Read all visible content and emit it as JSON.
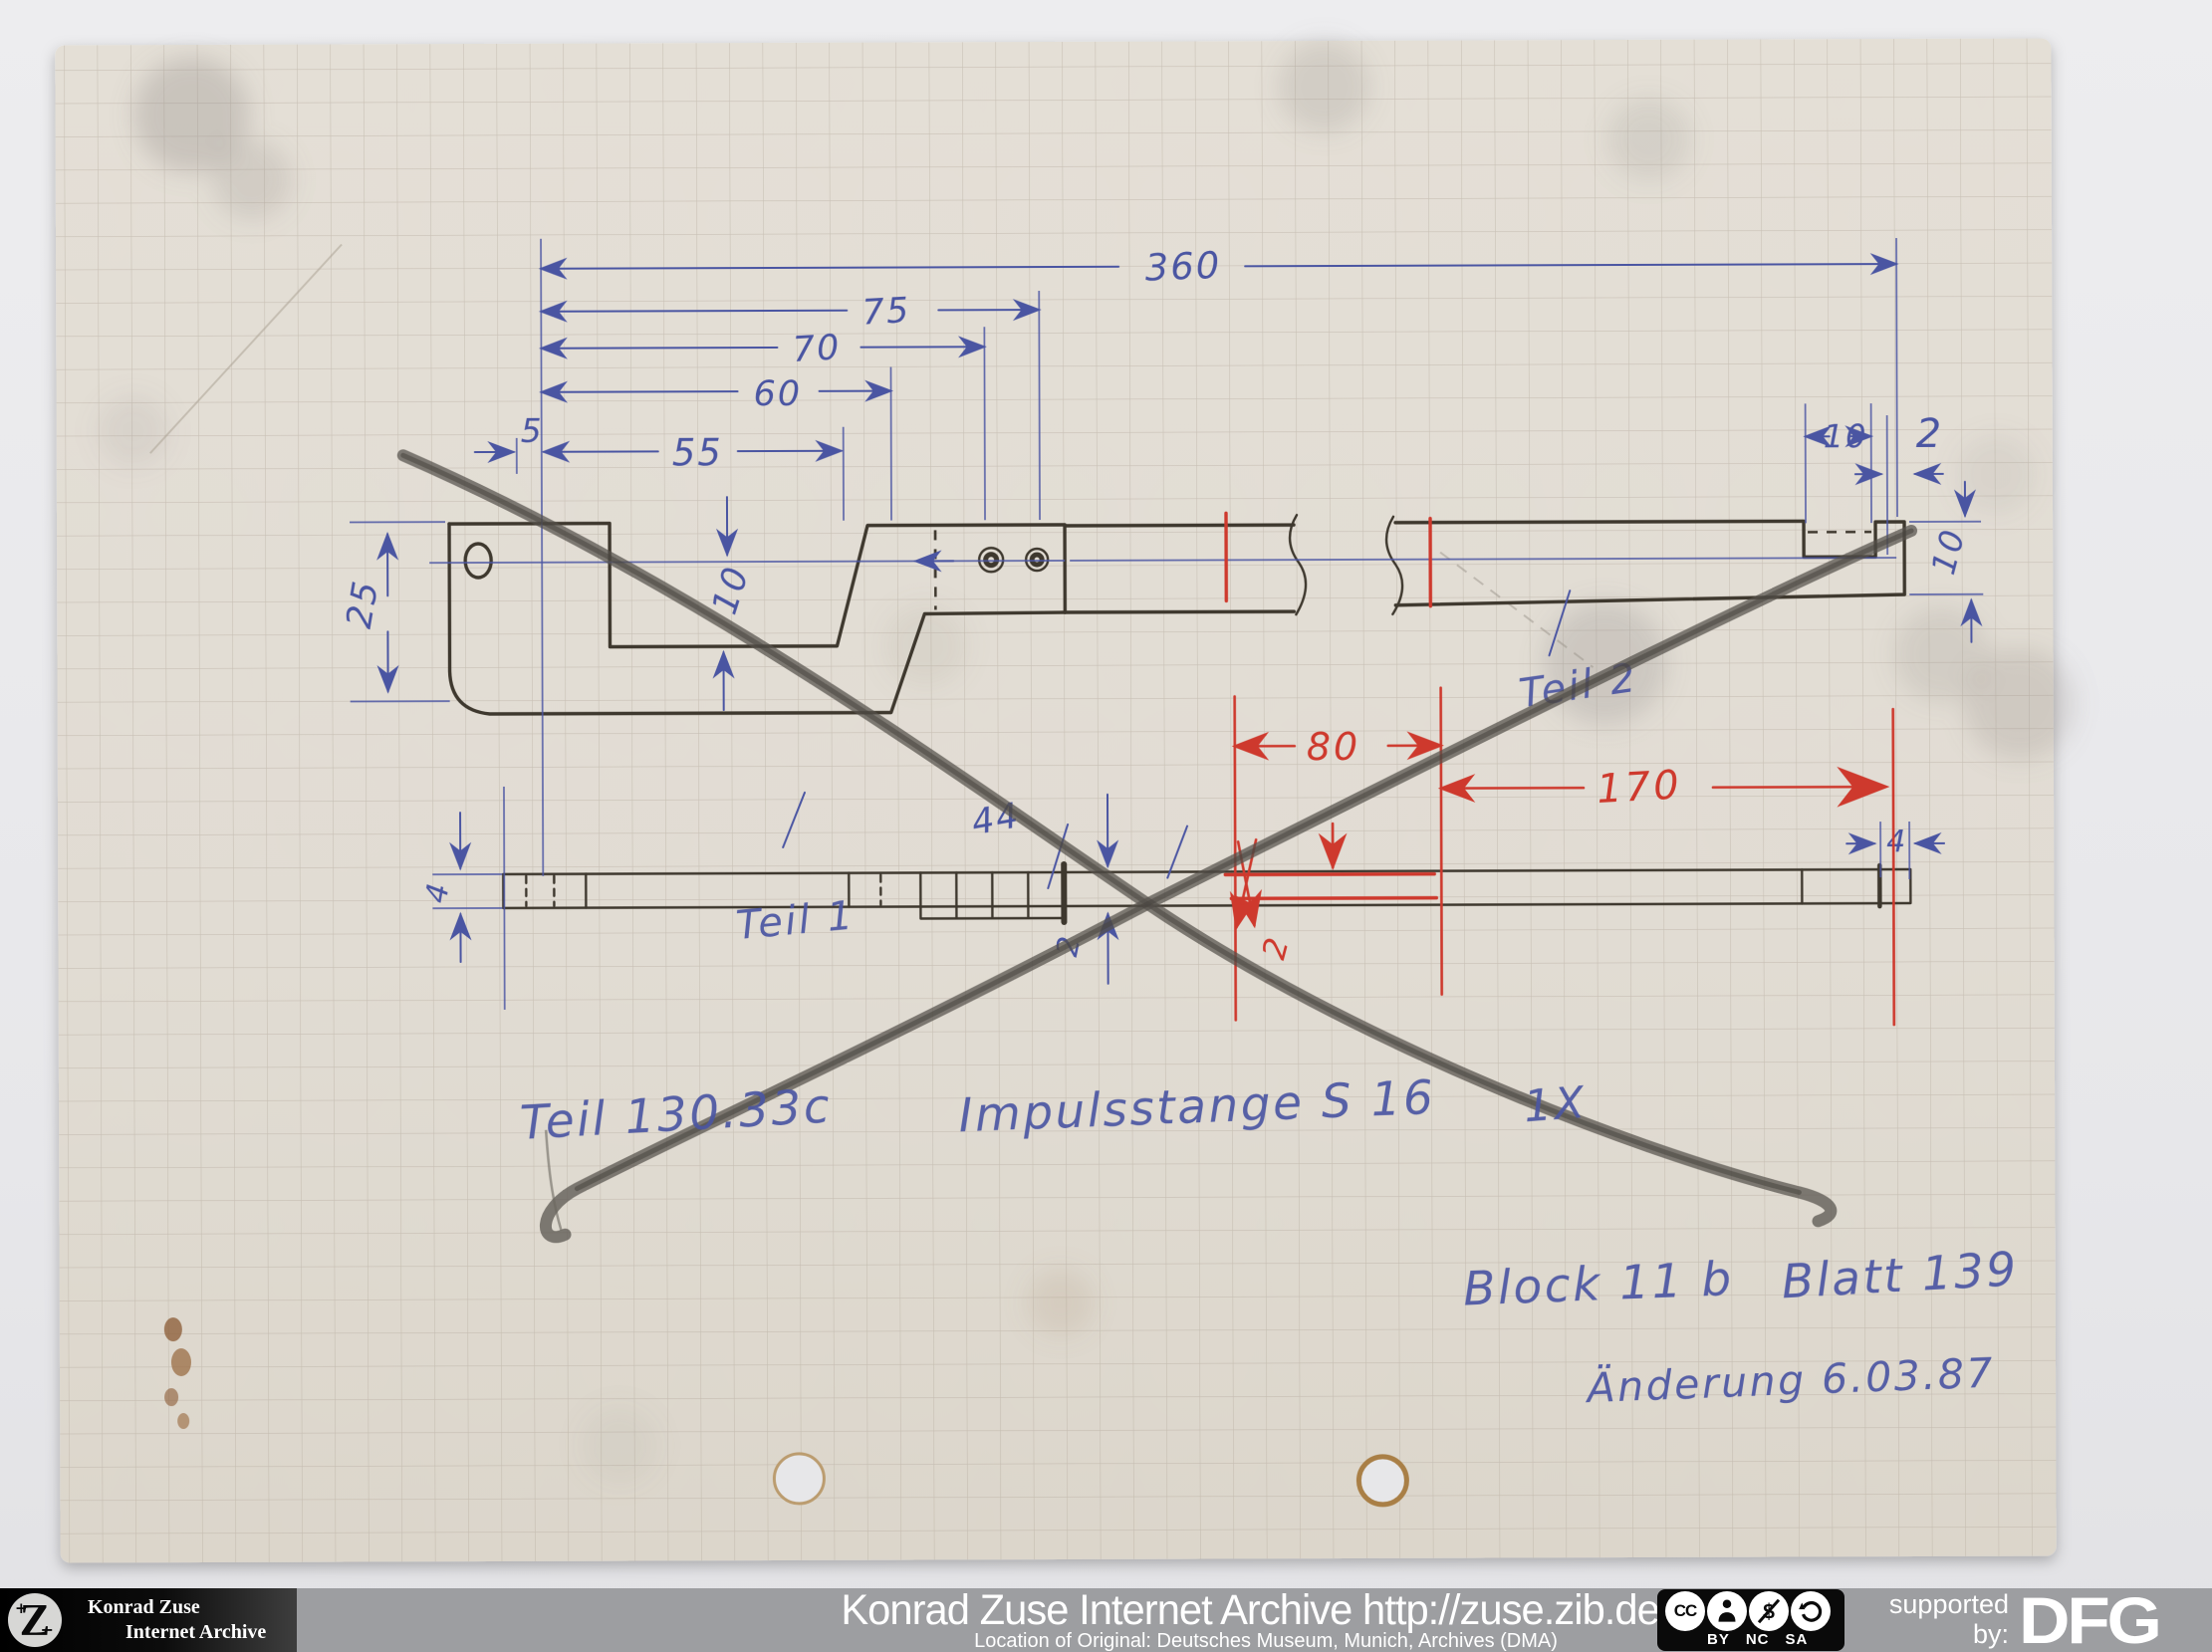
{
  "colors": {
    "background": "#e9e9ec",
    "paper": "#e2ddd4",
    "grid_line": "#b2a89b",
    "ink_blue": "#4a55a2",
    "ink_red": "#ce392d",
    "pencil": "#3e382e",
    "graphite": "#55504b",
    "footer_black": "#0a0a0a",
    "footer_gray": "#9d9ea1",
    "text_white": "#ffffff"
  },
  "drawing": {
    "dims": {
      "total": "360",
      "d75": "75",
      "d70": "70",
      "d60": "60",
      "d5": "5",
      "d55": "55",
      "d25": "25",
      "d10_pocket": "10",
      "d10_notch": "10",
      "d2_notch": "2",
      "d10_height": "10",
      "d4_left": "4",
      "d44": "44",
      "d2_strip": "2",
      "d4_right": "4"
    },
    "red_dims": {
      "d80": "80",
      "d170": "170",
      "d2": "2"
    },
    "labels": {
      "teil1": "Teil 1",
      "teil2": "Teil 2"
    },
    "title": {
      "part_no": "Teil 130.33c",
      "part_name": "Impulsstange S 16",
      "quantity": "1X"
    },
    "notes": {
      "block": "Block 11 b",
      "blatt": "Blatt 139",
      "change": "Änderung 6.03.87"
    }
  },
  "footer": {
    "logo": {
      "glyph": "Z",
      "plus": "+",
      "minus": "−",
      "line1": "Konrad Zuse",
      "line2": "Internet Archive"
    },
    "title": "Konrad Zuse Internet Archive http://zuse.zib.de",
    "subtitle": "Location of Original: Deutsches Museum, Munich, Archives (DMA)",
    "cc": {
      "cc": "CC",
      "by": "BY",
      "nc": "NC",
      "sa": "SA"
    },
    "supported_line1": "supported",
    "supported_line2": "by:",
    "dfg": "DFG"
  }
}
